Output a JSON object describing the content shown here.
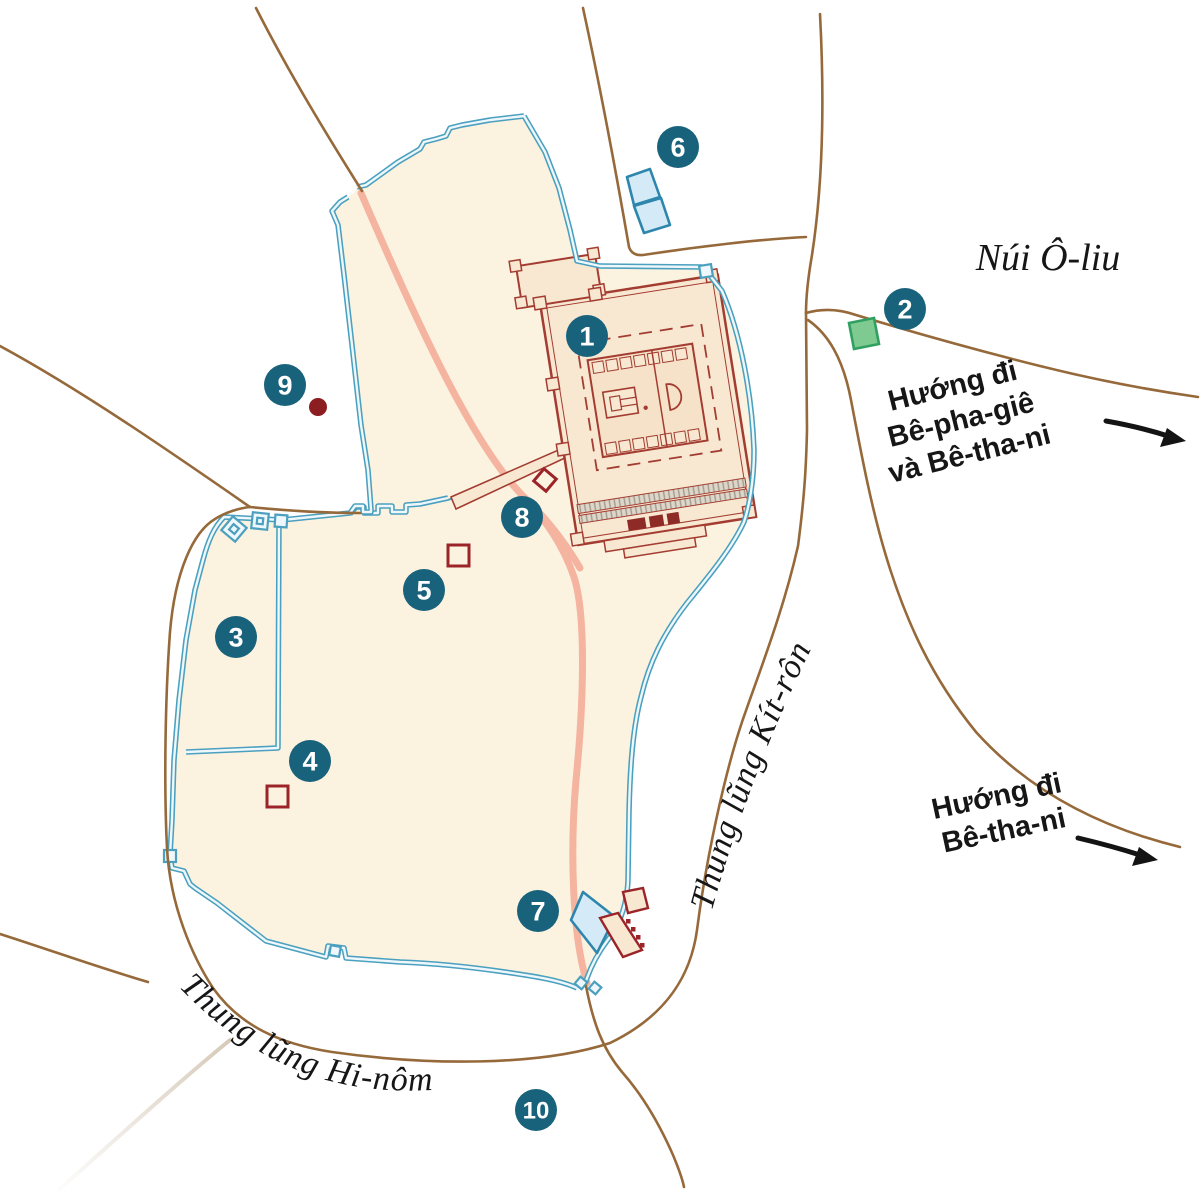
{
  "map": {
    "labels": {
      "mount_olives": "Núi Ô-liu",
      "kidron_valley": "Thung lũng Kít-rôn",
      "hinnom_valley": "Thung lũng Hi-nôm",
      "to_bethphage_lines": [
        "Hướng đi",
        "Bê-pha-giê",
        "và Bê-tha-ni"
      ],
      "to_bethany_lines": [
        "Hướng đi",
        "Bê-tha-ni"
      ]
    },
    "markers": [
      {
        "number": "1",
        "x": 587,
        "y": 336
      },
      {
        "number": "2",
        "x": 905,
        "y": 309
      },
      {
        "number": "3",
        "x": 236,
        "y": 637
      },
      {
        "number": "4",
        "x": 310,
        "y": 761
      },
      {
        "number": "5",
        "x": 424,
        "y": 590
      },
      {
        "number": "6",
        "x": 678,
        "y": 147
      },
      {
        "number": "7",
        "x": 538,
        "y": 911
      },
      {
        "number": "8",
        "x": 522,
        "y": 517
      },
      {
        "number": "9",
        "x": 285,
        "y": 385
      },
      {
        "number": "10",
        "x": 536,
        "y": 1110
      }
    ],
    "colors": {
      "marker_fill": "#19627b",
      "marker_text": "#ffffff",
      "wall_stroke": "#4aa0be",
      "wall_inner": "#eef7fb",
      "city_fill": "#fcf2e0",
      "temple_fill": "#f8e8d2",
      "temple_stroke": "#a33c31",
      "temple_dark": "#8e2b26",
      "road": "#96693a",
      "path_salmon": "#f4b4a0",
      "pool_fill": "#d4ebf7",
      "pool_stroke": "#2e86ad",
      "green_fill": "#7fca90",
      "green_stroke": "#2fa05f",
      "dark_red": "#8c1d20",
      "red_square_stroke": "#9b2428",
      "label_text": "#161616"
    }
  }
}
